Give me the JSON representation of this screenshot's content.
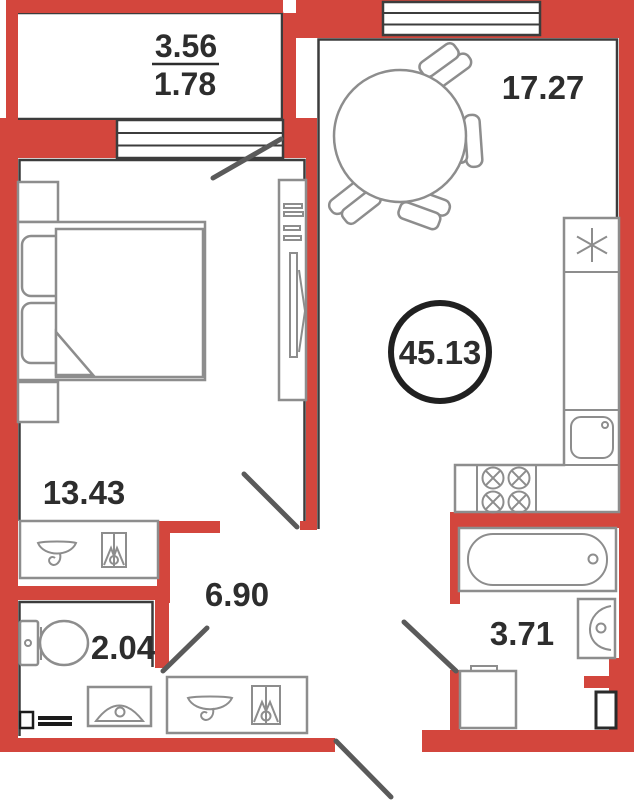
{
  "plan": {
    "type": "apartment-floor-plan",
    "areas": {
      "balcony_full": "3.56",
      "balcony_reduced": "1.78",
      "living_kitchen": "17.27",
      "bedroom": "13.43",
      "hallway": "6.90",
      "wc": "2.04",
      "bathroom": "3.71",
      "total": "45.13"
    },
    "icons": {
      "fridge": "snowflake-icon",
      "stove": "four-crossed-burners-icon",
      "kitchen_sink": "square-basin-icon",
      "bathtub": "tub-icon",
      "washbasin": "basin-with-trap-icon",
      "washing_machine": "machine-box-icon",
      "toilet": "tank-and-bowl-icon",
      "radiator": "radiator-icon",
      "bed": "double-bed-icon",
      "dining_table": "round-table-with-chairs-icon",
      "wardrobe": "closet-with-rod-icon",
      "door": "swing-line-icon",
      "window": "triple-line-band-icon"
    },
    "colors": {
      "wall_red": "#d3463d",
      "line_dark": "#3c3c3c",
      "furn_gray": "#8d8d8d",
      "door_gray": "#5a5a5a",
      "text_dark": "#2d2d2d",
      "badge_ring": "#202020",
      "rad_black": "#1b1b1b"
    }
  }
}
